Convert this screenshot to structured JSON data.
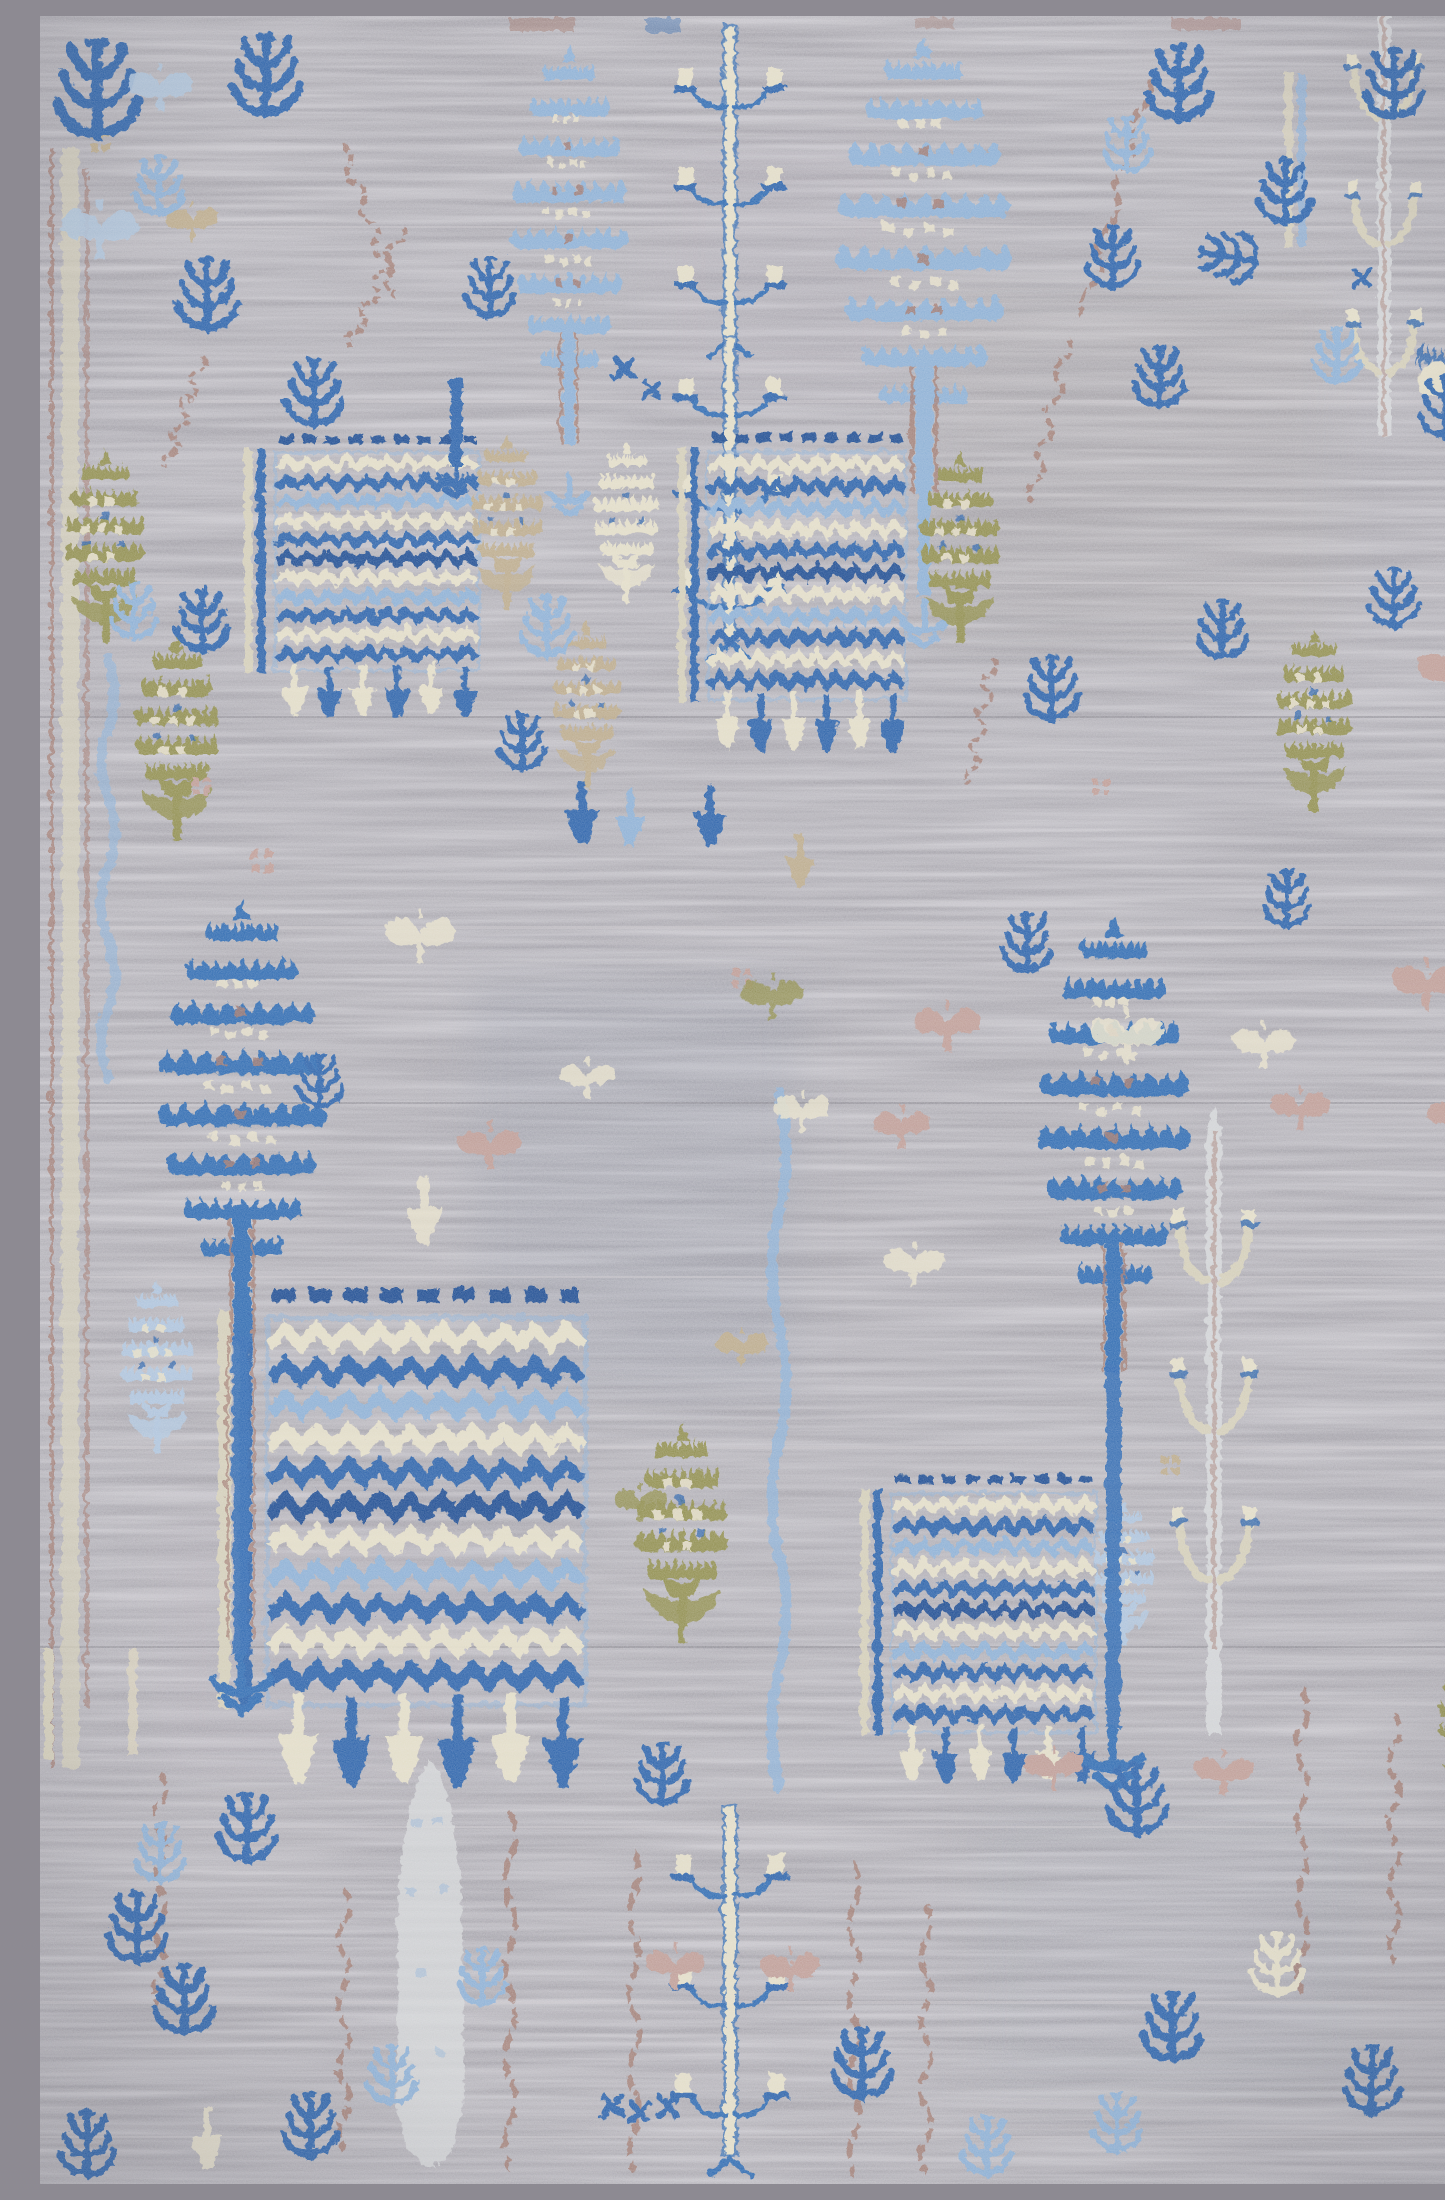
{
  "image": {
    "type": "photograph",
    "subject": "Hand-knotted wool area rug, overhead detail view",
    "visible_text": "",
    "alt_text": "Overhead photograph of a hand-knotted wool rug with a soft gray striated field and an all-over tree-of-life pattern: royal-blue and light-blue pagoda-shaped cypress trees, rectangular blue willow panels woven in zigzag rows, olive-green and tan pinecone flowers, pale cream candelabra trees, rose-brown chain vines, and many small scattered blue sprig motifs."
  },
  "palette": {
    "field": "#a7a5ac",
    "field_light": "#c7c4c9",
    "field_dark": "#8d8a92",
    "royal_blue": "#2a64ad",
    "medium_blue": "#2f6cb4",
    "navy": "#1d4e94",
    "light_blue": "#8fb3d9",
    "pale_blue": "#b1c8e0",
    "cream": "#e7e1cb",
    "cream_dark": "#d8d2bc",
    "olive": "#93914f",
    "tan": "#bfae8d",
    "rose_brown": "#a1786d",
    "dusty_pink": "#c2a098",
    "ghost_gray": "#d6d8da"
  },
  "motifs": [
    {
      "name": "royal-blue pagoda cypress tree",
      "count": 2,
      "color": "medium_blue"
    },
    {
      "name": "light-blue pagoda cypress tree",
      "count": 2,
      "color": "light_blue"
    },
    {
      "name": "willow panel of zigzag rows",
      "count": 4,
      "colors": [
        "royal_blue",
        "cream",
        "light_blue"
      ]
    },
    {
      "name": "pinecone flower tree",
      "count": 11,
      "colors": [
        "olive",
        "tan",
        "cream",
        "pale_blue"
      ]
    },
    {
      "name": "tree-of-life with cream trunk",
      "count": 3,
      "colors": [
        "cream",
        "medium_blue"
      ]
    },
    {
      "name": "pale candelabra tree",
      "count": 2,
      "color": "ghost_gray"
    },
    {
      "name": "ghost cypress silhouette",
      "count": 1,
      "color": "ghost_gray"
    },
    {
      "name": "small sprig",
      "count": 44,
      "colors": [
        "royal_blue",
        "light_blue"
      ]
    },
    {
      "name": "chain vine",
      "count": 14,
      "color": "rose_brown"
    },
    {
      "name": "blossom bud",
      "count": 22,
      "colors": [
        "cream",
        "dusty_pink",
        "olive",
        "pale_blue",
        "tan"
      ]
    }
  ]
}
